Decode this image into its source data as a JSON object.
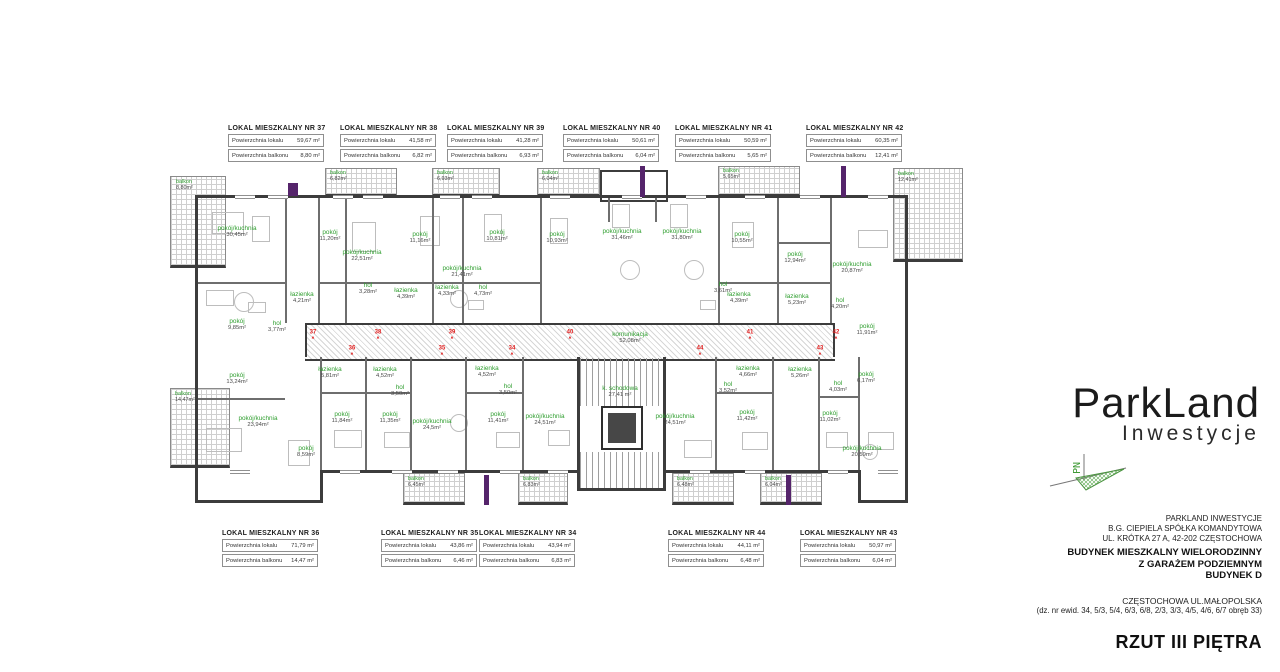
{
  "sheet": {
    "title": "RZUT III PIĘTRA"
  },
  "logo": {
    "brand": "ParkLand",
    "subtitle": "Inwestycje",
    "north_label": "PN"
  },
  "address": {
    "company_lines": [
      "PARKLAND INWESTYCJE",
      "B.G. CIEPIELA SPÓŁKA KOMANDYTOWA",
      "UL. KRÓTKA 27 A, 42-202 CZĘSTOCHOWA"
    ],
    "building_lines": [
      "BUDYNEK MIESZKALNY WIELORODZINNY",
      "Z GARAŻEM PODZIEMNYM",
      "BUDYNEK D"
    ],
    "location": "CZĘSTOCHOWA UL.MAŁOPOLSKA",
    "plot": "(dz. nr ewid. 34, 5/3, 5/4, 6/3, 6/8, 2/3, 3/3, 4/5, 4/6, 6/7 obręb 33)"
  },
  "legend_labels": {
    "area": "Powierzchnia lokalu",
    "balcony": "Powierzchnia balkonu"
  },
  "apartments": {
    "top": [
      {
        "title": "LOKAL MIESZKALNY NR 37",
        "area": "59,67 m²",
        "balcony": "8,80 m²",
        "left": 228,
        "top": 125
      },
      {
        "title": "LOKAL MIESZKALNY NR 38",
        "area": "41,58 m²",
        "balcony": "6,82 m²",
        "left": 340,
        "top": 125
      },
      {
        "title": "LOKAL MIESZKALNY NR 39",
        "area": "41,28 m²",
        "balcony": "6,93 m²",
        "left": 447,
        "top": 125
      },
      {
        "title": "LOKAL MIESZKALNY NR 40",
        "area": "50,61 m²",
        "balcony": "6,04 m²",
        "left": 563,
        "top": 125
      },
      {
        "title": "LOKAL MIESZKALNY NR 41",
        "area": "50,59 m²",
        "balcony": "5,65 m²",
        "left": 675,
        "top": 125
      },
      {
        "title": "LOKAL MIESZKALNY NR 42",
        "area": "60,35 m²",
        "balcony": "12,41 m²",
        "left": 806,
        "top": 125
      }
    ],
    "bottom": [
      {
        "title": "LOKAL MIESZKALNY NR 36",
        "area": "71,79 m²",
        "balcony": "14,47 m²",
        "left": 222,
        "top": 530
      },
      {
        "title": "LOKAL MIESZKALNY NR 35",
        "area": "43,86 m²",
        "balcony": "6,46 m²",
        "left": 381,
        "top": 530
      },
      {
        "title": "LOKAL MIESZKALNY NR 34",
        "area": "43,94 m²",
        "balcony": "6,83 m²",
        "left": 479,
        "top": 530
      },
      {
        "title": "LOKAL MIESZKALNY NR 44",
        "area": "44,11 m²",
        "balcony": "6,48 m²",
        "left": 668,
        "top": 530
      },
      {
        "title": "LOKAL MIESZKALNY NR 43",
        "area": "50,97 m²",
        "balcony": "6,04 m²",
        "left": 800,
        "top": 530
      }
    ]
  },
  "plan": {
    "rooms": [
      {
        "name": "pokój/kuchnia",
        "area": "30,45m²",
        "x": 237,
        "y": 232
      },
      {
        "name": "pokój",
        "area": "11,20m²",
        "x": 330,
        "y": 236
      },
      {
        "name": "pokój/kuchnia",
        "area": "22,51m²",
        "x": 362,
        "y": 256
      },
      {
        "name": "pokój",
        "area": "11,16m²",
        "x": 420,
        "y": 238
      },
      {
        "name": "pokój/kuchnia",
        "area": "21,41m²",
        "x": 462,
        "y": 272
      },
      {
        "name": "pokój",
        "area": "10,81m²",
        "x": 497,
        "y": 236
      },
      {
        "name": "pokój",
        "area": "10,93m²",
        "x": 557,
        "y": 238
      },
      {
        "name": "pokój/kuchnia",
        "area": "31,46m²",
        "x": 622,
        "y": 235
      },
      {
        "name": "pokój/kuchnia",
        "area": "31,80m²",
        "x": 682,
        "y": 235
      },
      {
        "name": "pokój",
        "area": "10,55m²",
        "x": 742,
        "y": 238
      },
      {
        "name": "pokój",
        "area": "12,94m²",
        "x": 795,
        "y": 258
      },
      {
        "name": "pokój/kuchnia",
        "area": "20,87m²",
        "x": 852,
        "y": 268
      },
      {
        "name": "pokój",
        "area": "9,85m²",
        "x": 237,
        "y": 325
      },
      {
        "name": "hol",
        "area": "3,77m²",
        "x": 277,
        "y": 327
      },
      {
        "name": "łazienka",
        "area": "4,21m²",
        "x": 302,
        "y": 298
      },
      {
        "name": "hol",
        "area": "3,28m²",
        "x": 368,
        "y": 289
      },
      {
        "name": "łazienka",
        "area": "4,39m²",
        "x": 406,
        "y": 294
      },
      {
        "name": "łazienka",
        "area": "4,33m²",
        "x": 447,
        "y": 291
      },
      {
        "name": "hol",
        "area": "4,73m²",
        "x": 483,
        "y": 291
      },
      {
        "name": "hol",
        "area": "3,61m²",
        "x": 723,
        "y": 288
      },
      {
        "name": "łazienka",
        "area": "4,39m²",
        "x": 739,
        "y": 298
      },
      {
        "name": "łazienka",
        "area": "5,23m²",
        "x": 797,
        "y": 300
      },
      {
        "name": "hol",
        "area": "4,20m²",
        "x": 840,
        "y": 304
      },
      {
        "name": "pokój",
        "area": "11,91m²",
        "x": 867,
        "y": 330
      },
      {
        "name": "komunikacja",
        "area": "52,08m²",
        "x": 630,
        "y": 338
      },
      {
        "name": "k. schodowa",
        "area": "27,41 m²",
        "x": 620,
        "y": 392
      },
      {
        "name": "pokój",
        "area": "13,24m²",
        "x": 237,
        "y": 379
      },
      {
        "name": "pokój/kuchnia",
        "area": "23,94m²",
        "x": 258,
        "y": 422
      },
      {
        "name": "pokój",
        "area": "8,59m²",
        "x": 306,
        "y": 452
      },
      {
        "name": "łazienka",
        "area": "5,81m²",
        "x": 330,
        "y": 373
      },
      {
        "name": "łazienka",
        "area": "4,52m²",
        "x": 385,
        "y": 373
      },
      {
        "name": "hol",
        "area": "3,50m²",
        "x": 400,
        "y": 391
      },
      {
        "name": "pokój",
        "area": "11,84m²",
        "x": 342,
        "y": 418
      },
      {
        "name": "pokój",
        "area": "11,35m²",
        "x": 390,
        "y": 418
      },
      {
        "name": "pokój/kuchnia",
        "area": "24,5m²",
        "x": 432,
        "y": 425
      },
      {
        "name": "łazienka",
        "area": "4,52m²",
        "x": 487,
        "y": 372
      },
      {
        "name": "hol",
        "area": "3,50m²",
        "x": 508,
        "y": 390
      },
      {
        "name": "pokój",
        "area": "11,41m²",
        "x": 498,
        "y": 418
      },
      {
        "name": "pokój/kuchnia",
        "area": "24,51m²",
        "x": 545,
        "y": 420
      },
      {
        "name": "pokój/kuchnia",
        "area": "24,51m²",
        "x": 675,
        "y": 420
      },
      {
        "name": "hol",
        "area": "3,52m²",
        "x": 728,
        "y": 388
      },
      {
        "name": "łazienka",
        "area": "4,66m²",
        "x": 748,
        "y": 372
      },
      {
        "name": "pokój",
        "area": "11,42m²",
        "x": 747,
        "y": 416
      },
      {
        "name": "łazienka",
        "area": "5,26m²",
        "x": 800,
        "y": 373
      },
      {
        "name": "hol",
        "area": "4,03m²",
        "x": 838,
        "y": 387
      },
      {
        "name": "pokój",
        "area": "6,17m²",
        "x": 866,
        "y": 378
      },
      {
        "name": "pokój",
        "area": "11,02m²",
        "x": 830,
        "y": 417
      },
      {
        "name": "pokój/kuchnia",
        "area": "20,59m²",
        "x": 862,
        "y": 452
      }
    ],
    "balconies": [
      {
        "x": 170,
        "y": 176,
        "w": 56,
        "h": 92,
        "name": "balkon",
        "area": "8,80m²",
        "lx": 176,
        "ly": 180
      },
      {
        "x": 325,
        "y": 168,
        "w": 72,
        "h": 29,
        "name": "balkon",
        "area": "6,82m²",
        "lx": 330,
        "ly": 171
      },
      {
        "x": 432,
        "y": 168,
        "w": 68,
        "h": 29,
        "name": "balkon",
        "area": "6,93m²",
        "lx": 437,
        "ly": 171
      },
      {
        "x": 537,
        "y": 168,
        "w": 63,
        "h": 29,
        "name": "balkon",
        "area": "6,04m²",
        "lx": 542,
        "ly": 171
      },
      {
        "x": 718,
        "y": 166,
        "w": 82,
        "h": 31,
        "name": "balkon",
        "area": "5,65m²",
        "lx": 723,
        "ly": 169
      },
      {
        "x": 893,
        "y": 168,
        "w": 70,
        "h": 94,
        "name": "balkon",
        "area": "12,41m²",
        "lx": 898,
        "ly": 172
      },
      {
        "x": 170,
        "y": 388,
        "w": 60,
        "h": 80,
        "name": "balkon",
        "area": "14,47m²",
        "lx": 175,
        "ly": 392
      },
      {
        "x": 403,
        "y": 473,
        "w": 62,
        "h": 32,
        "name": "balkon",
        "area": "6,45m²",
        "lx": 408,
        "ly": 477
      },
      {
        "x": 518,
        "y": 473,
        "w": 50,
        "h": 32,
        "name": "balkon",
        "area": "6,83m²",
        "lx": 523,
        "ly": 477
      },
      {
        "x": 672,
        "y": 473,
        "w": 62,
        "h": 32,
        "name": "balkon",
        "area": "6,48m²",
        "lx": 677,
        "ly": 477
      },
      {
        "x": 760,
        "y": 473,
        "w": 62,
        "h": 32,
        "name": "balkon",
        "area": "6,04m²",
        "lx": 765,
        "ly": 477
      }
    ],
    "loggia": {
      "x": 600,
      "y": 170,
      "w": 64,
      "h": 28
    },
    "corridor": {
      "x": 305,
      "y": 323,
      "w": 530,
      "h": 34
    },
    "stairs": [
      {
        "x": 580,
        "y": 358,
        "w": 83,
        "h": 48
      },
      {
        "x": 580,
        "y": 452,
        "w": 83,
        "h": 36
      }
    ],
    "elevator": {
      "x": 601,
      "y": 406,
      "w": 42,
      "h": 44
    },
    "walls": [
      [
        197,
        195,
        711,
        3
      ],
      [
        195,
        195,
        3,
        308
      ],
      [
        905,
        195,
        3,
        308
      ],
      [
        195,
        500,
        128,
        3
      ],
      [
        320,
        470,
        3,
        33
      ],
      [
        323,
        470,
        256,
        3
      ],
      [
        663,
        470,
        197,
        3
      ],
      [
        858,
        470,
        3,
        33
      ],
      [
        858,
        500,
        50,
        3
      ],
      [
        577,
        470,
        3,
        21
      ],
      [
        663,
        470,
        3,
        21
      ],
      [
        577,
        488,
        89,
        3
      ],
      [
        577,
        357,
        3,
        113
      ],
      [
        663,
        357,
        3,
        113
      ],
      [
        305,
        323,
        2,
        34
      ],
      [
        833,
        323,
        2,
        34
      ]
    ],
    "partitions": [
      [
        285,
        198,
        2,
        125
      ],
      [
        318,
        198,
        2,
        125
      ],
      [
        345,
        198,
        2,
        125
      ],
      [
        432,
        198,
        2,
        125
      ],
      [
        462,
        198,
        2,
        125
      ],
      [
        540,
        198,
        2,
        125
      ],
      [
        608,
        198,
        2,
        24
      ],
      [
        655,
        198,
        2,
        24
      ],
      [
        718,
        198,
        2,
        125
      ],
      [
        777,
        198,
        2,
        125
      ],
      [
        830,
        198,
        2,
        125
      ],
      [
        320,
        357,
        2,
        113
      ],
      [
        365,
        357,
        2,
        113
      ],
      [
        410,
        357,
        2,
        113
      ],
      [
        465,
        357,
        2,
        113
      ],
      [
        522,
        357,
        2,
        113
      ],
      [
        715,
        357,
        2,
        113
      ],
      [
        772,
        357,
        2,
        113
      ],
      [
        818,
        357,
        2,
        113
      ],
      [
        858,
        357,
        2,
        113
      ],
      [
        318,
        282,
        114,
        2
      ],
      [
        432,
        282,
        108,
        2
      ],
      [
        718,
        282,
        112,
        2
      ],
      [
        777,
        242,
        53,
        2
      ],
      [
        320,
        392,
        90,
        2
      ],
      [
        465,
        392,
        57,
        2
      ],
      [
        715,
        392,
        57,
        2
      ],
      [
        818,
        396,
        40,
        2
      ],
      [
        197,
        398,
        88,
        2
      ],
      [
        197,
        282,
        88,
        2
      ]
    ],
    "purple_marks": [
      [
        640,
        166,
        5,
        31
      ],
      [
        841,
        166,
        5,
        31
      ],
      [
        484,
        475,
        5,
        30
      ],
      [
        786,
        475,
        5,
        30
      ],
      [
        288,
        183,
        10,
        13
      ]
    ],
    "windows": [
      [
        235,
        195,
        20
      ],
      [
        268,
        195,
        20
      ],
      [
        333,
        195,
        20
      ],
      [
        363,
        195,
        20
      ],
      [
        440,
        195,
        20
      ],
      [
        472,
        195,
        20
      ],
      [
        550,
        195,
        20
      ],
      [
        622,
        195,
        20
      ],
      [
        686,
        195,
        20
      ],
      [
        745,
        195,
        20
      ],
      [
        800,
        195,
        20
      ],
      [
        868,
        195,
        20
      ],
      [
        230,
        470,
        20
      ],
      [
        340,
        470,
        20
      ],
      [
        392,
        470,
        20
      ],
      [
        438,
        470,
        20
      ],
      [
        500,
        470,
        20
      ],
      [
        548,
        470,
        20
      ],
      [
        690,
        470,
        20
      ],
      [
        745,
        470,
        20
      ],
      [
        828,
        470,
        20
      ],
      [
        878,
        470,
        20
      ]
    ],
    "markers": [
      {
        "nr": "37",
        "x": 313,
        "y": 334
      },
      {
        "nr": "38",
        "x": 378,
        "y": 334
      },
      {
        "nr": "39",
        "x": 452,
        "y": 334
      },
      {
        "nr": "40",
        "x": 570,
        "y": 334
      },
      {
        "nr": "41",
        "x": 750,
        "y": 334
      },
      {
        "nr": "42",
        "x": 836,
        "y": 334
      },
      {
        "nr": "36",
        "x": 352,
        "y": 350
      },
      {
        "nr": "35",
        "x": 442,
        "y": 350
      },
      {
        "nr": "34",
        "x": 512,
        "y": 350
      },
      {
        "nr": "44",
        "x": 700,
        "y": 350
      },
      {
        "nr": "43",
        "x": 820,
        "y": 350
      }
    ],
    "furniture_rects": [
      [
        212,
        212,
        30,
        20
      ],
      [
        252,
        216,
        16,
        24
      ],
      [
        352,
        222,
        22,
        28
      ],
      [
        420,
        216,
        18,
        28
      ],
      [
        484,
        214,
        16,
        26
      ],
      [
        550,
        218,
        16,
        24
      ],
      [
        612,
        204,
        16,
        22
      ],
      [
        670,
        204,
        16,
        22
      ],
      [
        732,
        222,
        20,
        24
      ],
      [
        858,
        230,
        28,
        16
      ],
      [
        206,
        290,
        26,
        14
      ],
      [
        206,
        428,
        34,
        22
      ],
      [
        288,
        440,
        20,
        24
      ],
      [
        334,
        430,
        26,
        16
      ],
      [
        384,
        432,
        24,
        14
      ],
      [
        496,
        432,
        22,
        14
      ],
      [
        548,
        430,
        20,
        14
      ],
      [
        684,
        440,
        26,
        16
      ],
      [
        742,
        432,
        24,
        16
      ],
      [
        826,
        432,
        20,
        14
      ],
      [
        868,
        432,
        24,
        16
      ],
      [
        248,
        302,
        16,
        9
      ],
      [
        468,
        300,
        14,
        8
      ],
      [
        700,
        300,
        14,
        8
      ]
    ],
    "furniture_circles": [
      [
        234,
        292,
        18
      ],
      [
        450,
        290,
        16
      ],
      [
        620,
        260,
        18
      ],
      [
        684,
        260,
        18
      ],
      [
        450,
        414,
        16
      ],
      [
        862,
        444,
        14
      ]
    ]
  }
}
